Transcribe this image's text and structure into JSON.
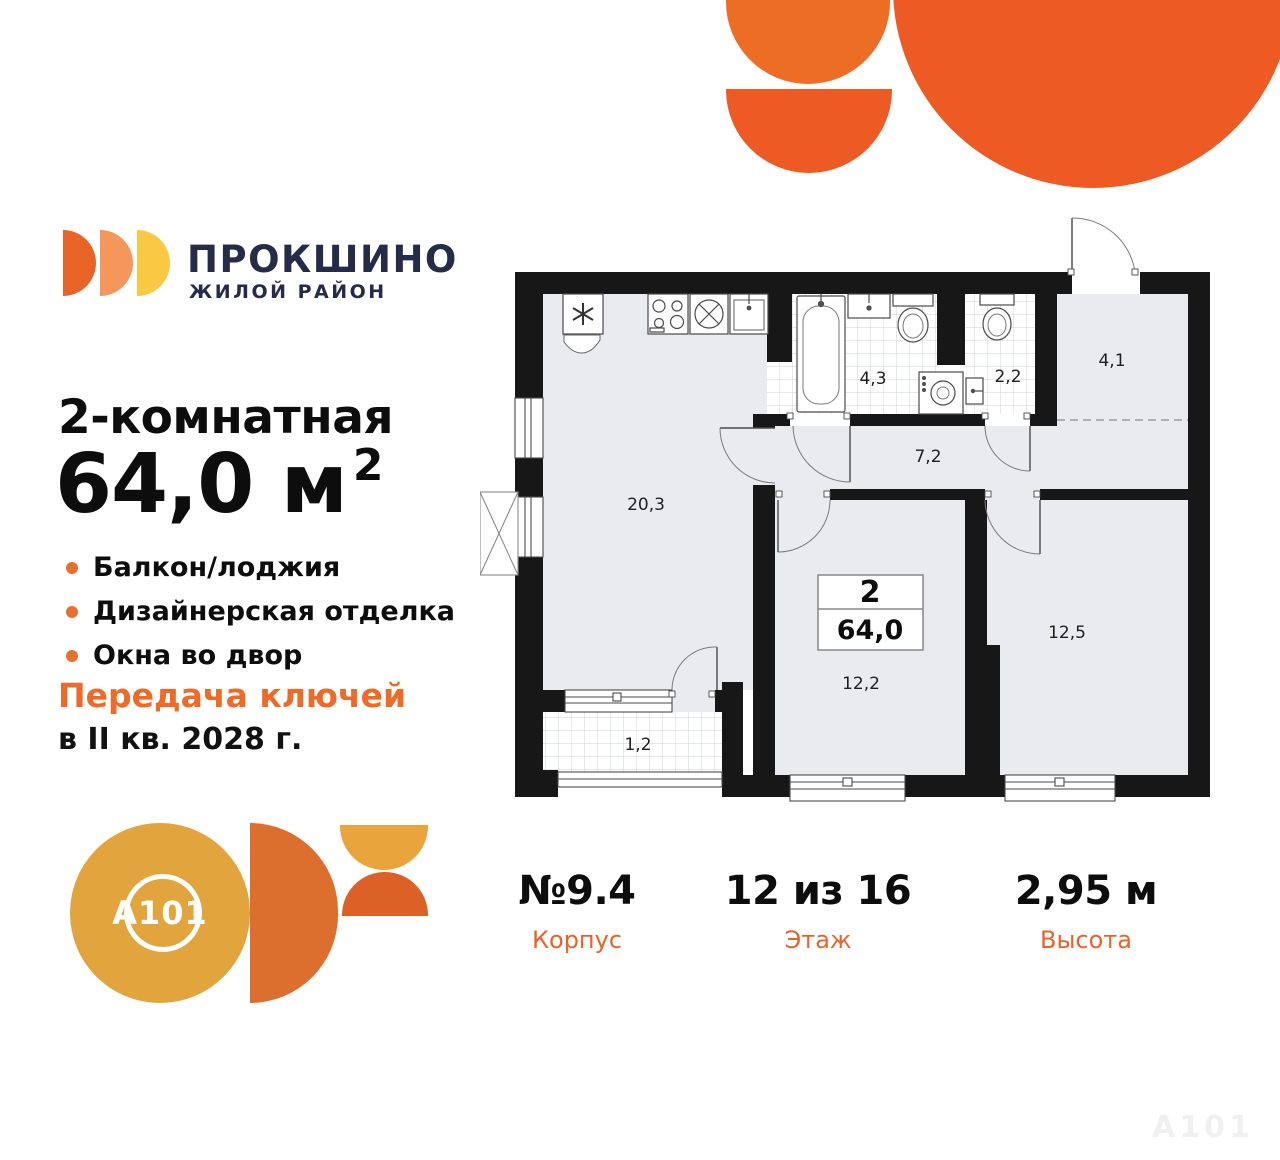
{
  "brand": {
    "name": "ПРОКШИНО",
    "tagline": "ЖИЛОЙ РАЙОН",
    "developer": "A101"
  },
  "listing": {
    "title": "2-комнатная",
    "area_value": "64,0",
    "area_unit": "м",
    "area_sup": "2",
    "features": [
      "Балкон/лоджия",
      "Дизайнерская отделка",
      "Окна во двор"
    ],
    "handover_line1": "Передача ключей",
    "handover_line2": "в II кв. 2028 г."
  },
  "plan": {
    "info_rooms": "2",
    "info_area": "64,0",
    "labels": {
      "living": "20,3",
      "bathroom": "4,3",
      "wc": "2,2",
      "hallway": "7,2",
      "loggia": "4,1",
      "bedroom1": "12,2",
      "bedroom2": "12,5",
      "balcony": "1,2"
    }
  },
  "details": {
    "building": {
      "value": "№9.4",
      "label": "Корпус"
    },
    "floor": {
      "value": "12 из 16",
      "label": "Этаж"
    },
    "height": {
      "value": "2,95 м",
      "label": "Высота"
    }
  },
  "colors": {
    "accent_orange": "#ee6a28",
    "brand_navy": "#252b49",
    "deco_orange_light": "#ed6d25",
    "deco_orange_deep": "#ee5a23",
    "a101_gold": "#e2a43c",
    "wall_black": "#171717",
    "room_fill": "#e9ebee"
  },
  "watermark": "A101"
}
